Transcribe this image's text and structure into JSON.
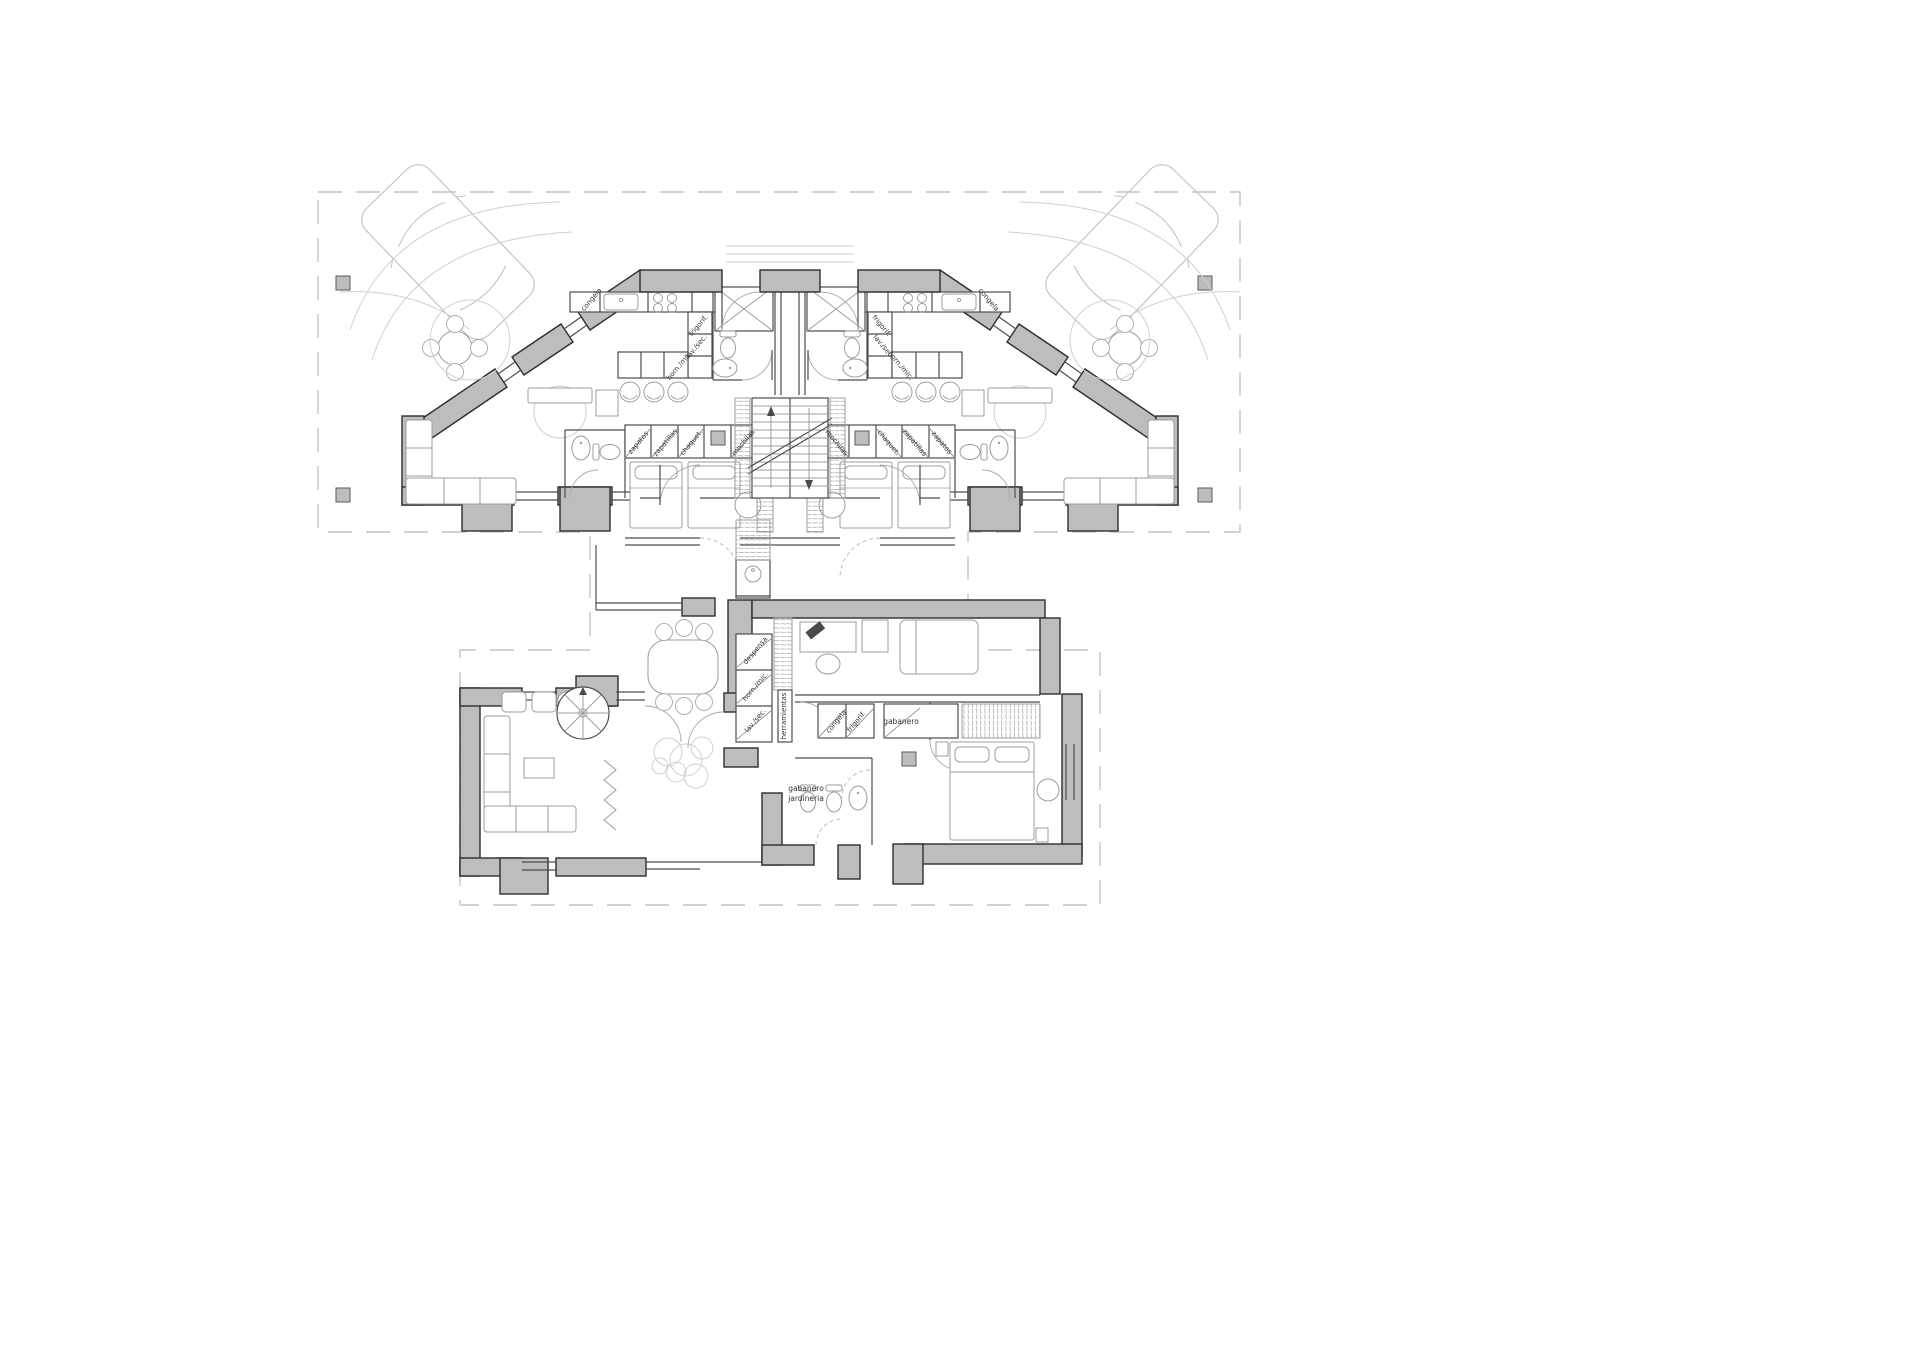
{
  "drawing": {
    "type": "floor-plan",
    "language": "es"
  },
  "palette": {
    "wall_fill": "#bdbdbd",
    "wall_stroke": "#2e2e2e",
    "thin_wall": "#4d4d4d",
    "furniture": "#9c9c9c",
    "site_dash": "#c3c3c3",
    "label_color": "#333333",
    "paper": "#ffffff"
  },
  "labels": [
    {
      "id": "wingL-congela",
      "text": "congela",
      "x": 593,
      "y": 301,
      "rot": -50,
      "size": 7
    },
    {
      "id": "wingL-frigorif",
      "text": "frigorif.",
      "x": 700,
      "y": 327,
      "rot": -50,
      "size": 7
    },
    {
      "id": "wingL-lavsec",
      "text": "lav./sec.",
      "x": 698,
      "y": 348,
      "rot": -50,
      "size": 7
    },
    {
      "id": "wingL-hornmic",
      "text": "horn./mic.",
      "x": 681,
      "y": 367,
      "rot": -50,
      "size": 7
    },
    {
      "id": "wingL-zapatos",
      "text": "zapatos",
      "x": 640,
      "y": 444,
      "rot": -50,
      "size": 7
    },
    {
      "id": "wingL-zapatillas",
      "text": "zapatillas",
      "x": 667,
      "y": 444,
      "rot": -50,
      "size": 7
    },
    {
      "id": "wingL-chaquet",
      "text": "chaquet.",
      "x": 693,
      "y": 444,
      "rot": -50,
      "size": 7
    },
    {
      "id": "wingL-mochilas",
      "text": "mochilas",
      "x": 745,
      "y": 444,
      "rot": -50,
      "size": 7
    },
    {
      "id": "wingR-congela",
      "text": "congela",
      "x": 987,
      "y": 301,
      "rot": 50,
      "size": 7
    },
    {
      "id": "wingR-frigorif",
      "text": "frigorif.",
      "x": 880,
      "y": 327,
      "rot": 50,
      "size": 7
    },
    {
      "id": "wingR-lavsec",
      "text": "lav./sec.",
      "x": 882,
      "y": 348,
      "rot": 50,
      "size": 7
    },
    {
      "id": "wingR-hornmic",
      "text": "horn./mic.",
      "x": 899,
      "y": 367,
      "rot": 50,
      "size": 7
    },
    {
      "id": "wingR-zapatos",
      "text": "zapatos",
      "x": 940,
      "y": 444,
      "rot": 50,
      "size": 7
    },
    {
      "id": "wingR-zapatillas",
      "text": "zapatillas",
      "x": 913,
      "y": 444,
      "rot": 50,
      "size": 7
    },
    {
      "id": "wingR-chaquet",
      "text": "chaquet.",
      "x": 887,
      "y": 444,
      "rot": 50,
      "size": 7
    },
    {
      "id": "wingR-mochilas",
      "text": "mochilas",
      "x": 835,
      "y": 444,
      "rot": 50,
      "size": 7
    },
    {
      "id": "low-herramientas",
      "text": "herramientas",
      "x": 786,
      "y": 716,
      "rot": -90,
      "size": 7
    },
    {
      "id": "low-despensa",
      "text": "despensa",
      "x": 757,
      "y": 652,
      "rot": -50,
      "size": 7
    },
    {
      "id": "low-hornmic",
      "text": "horn./mic.",
      "x": 757,
      "y": 688,
      "rot": -50,
      "size": 7
    },
    {
      "id": "low-lavsec",
      "text": "lav./sec.",
      "x": 757,
      "y": 722,
      "rot": -50,
      "size": 7
    },
    {
      "id": "low-congela",
      "text": "congela",
      "x": 838,
      "y": 723,
      "rot": -50,
      "size": 7
    },
    {
      "id": "low-frigorif",
      "text": "frigorif.",
      "x": 858,
      "y": 723,
      "rot": -50,
      "size": 7
    },
    {
      "id": "low-gabanero",
      "text": "gabanero",
      "x": 901,
      "y": 724,
      "rot": 0,
      "size": 7.5
    },
    {
      "id": "low-gabanero2",
      "text": "gabanero",
      "x": 806,
      "y": 791,
      "rot": 0,
      "size": 7.5
    },
    {
      "id": "low-jardineria",
      "text": "jardineria",
      "x": 806,
      "y": 801,
      "rot": 0,
      "size": 7.5
    }
  ]
}
